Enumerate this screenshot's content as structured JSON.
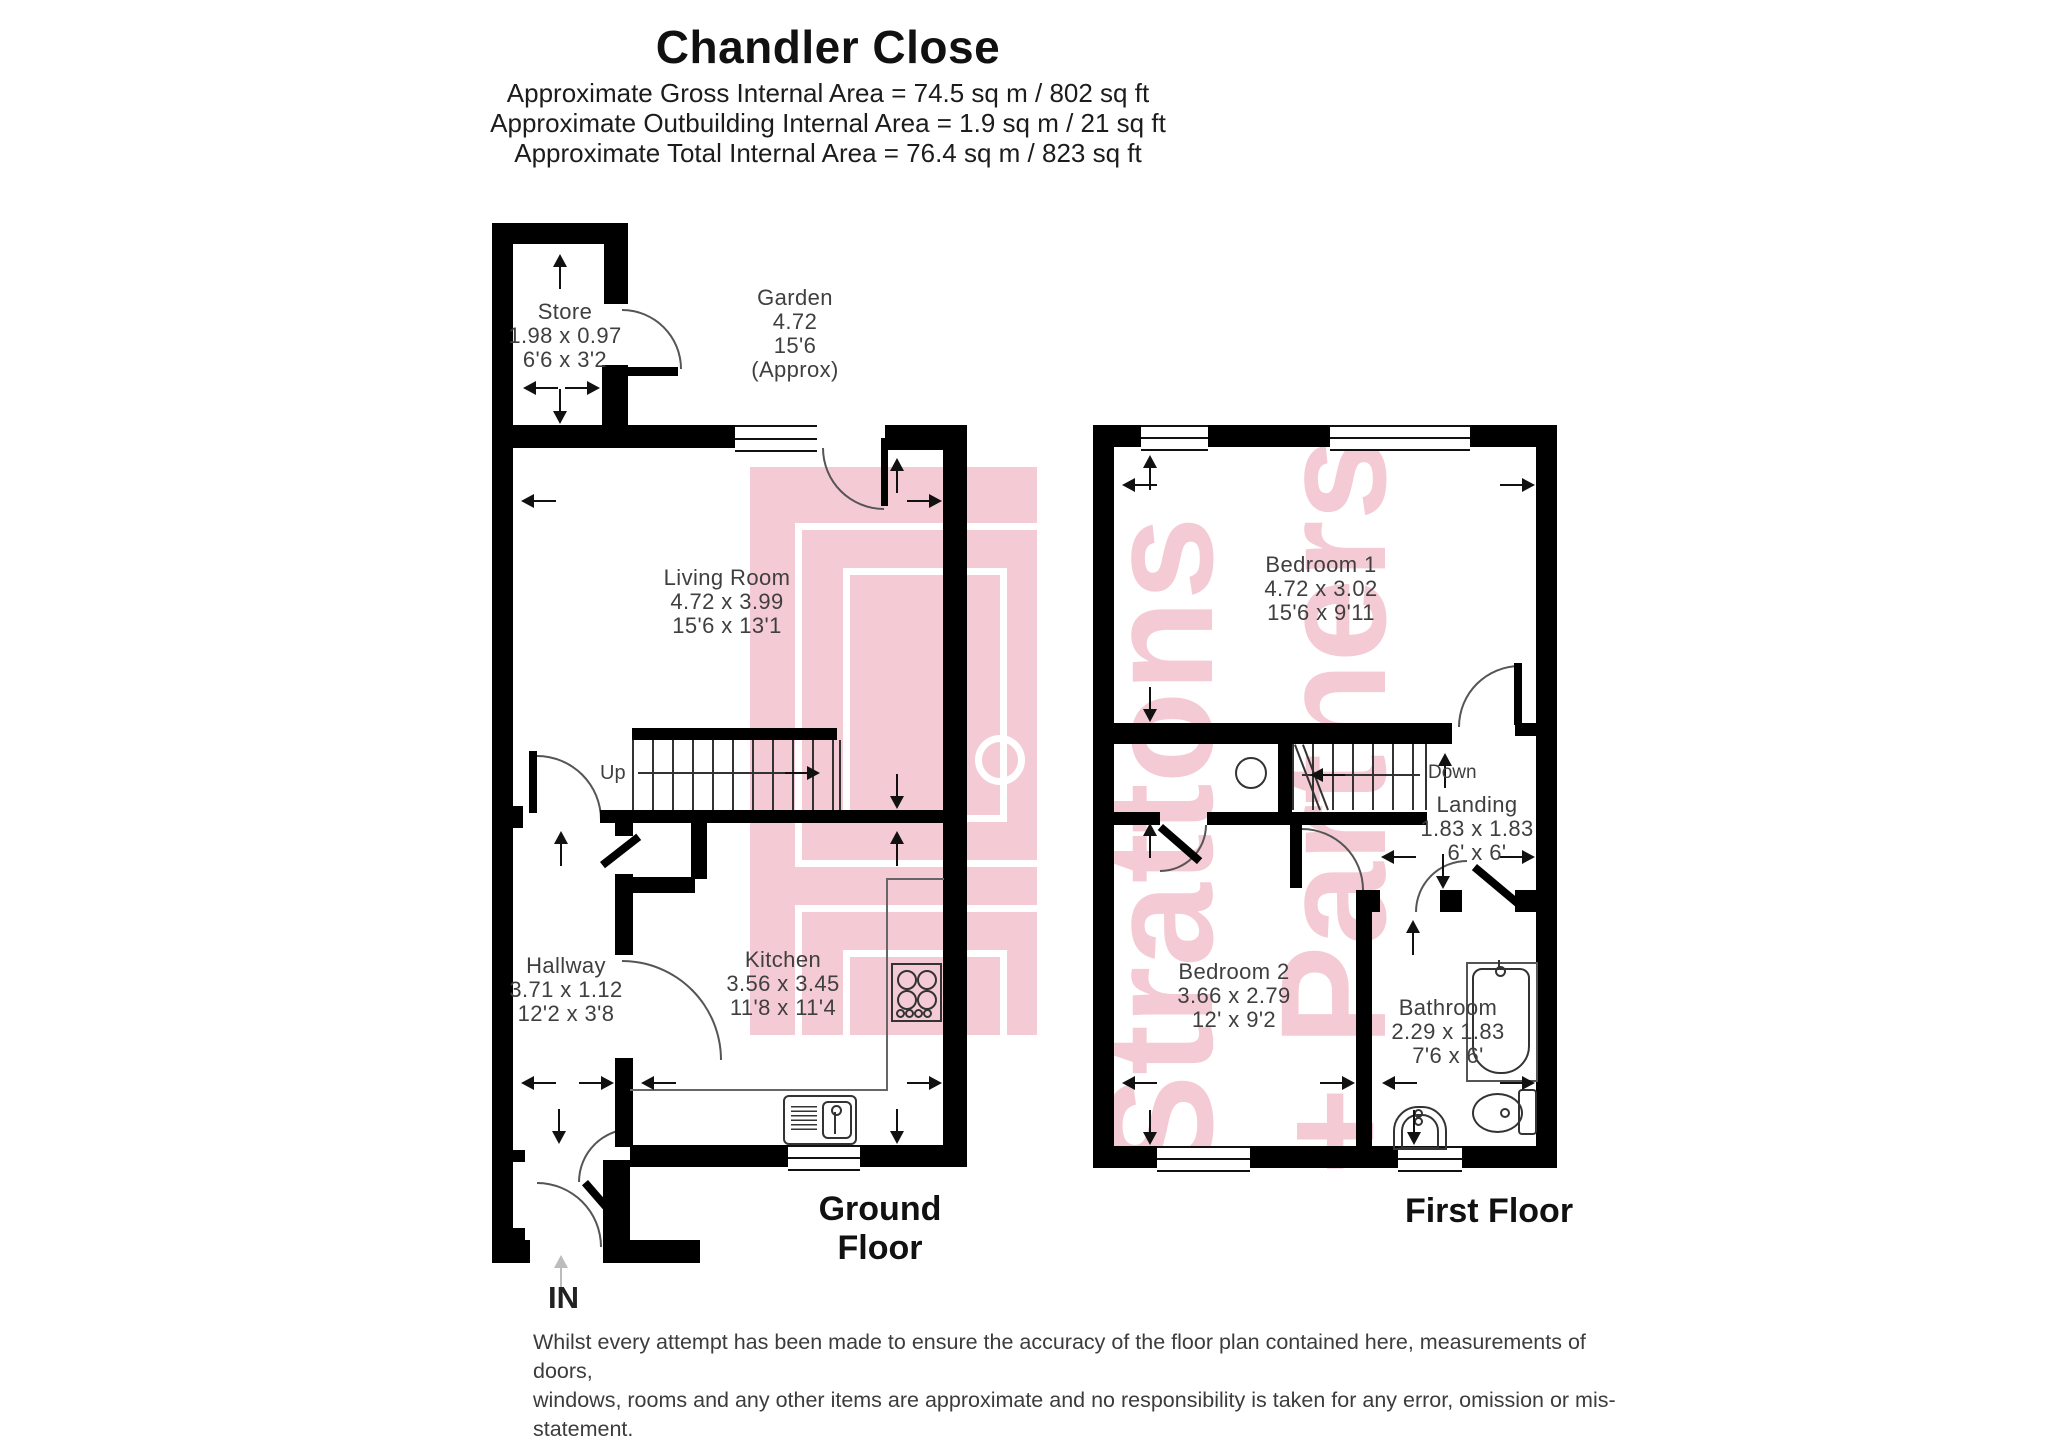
{
  "header": {
    "title": "Chandler Close",
    "area_lines": [
      "Approximate Gross Internal Area = 74.5 sq m / 802 sq ft",
      "Approximate Outbuilding Internal Area = 1.9 sq m / 21 sq ft",
      "Approximate Total Internal Area = 76.4 sq m / 823 sq ft"
    ]
  },
  "rooms": {
    "store": {
      "name": "Store",
      "metric": "1.98 x 0.97",
      "imperial": "6'6 x 3'2"
    },
    "garden": {
      "name": "Garden",
      "metric": "4.72",
      "imperial": "15'6",
      "note": "(Approx)"
    },
    "living_room": {
      "name": "Living Room",
      "metric": "4.72 x 3.99",
      "imperial": "15'6 x 13'1"
    },
    "hallway": {
      "name": "Hallway",
      "metric": "3.71 x 1.12",
      "imperial": "12'2 x 3'8"
    },
    "kitchen": {
      "name": "Kitchen",
      "metric": "3.56 x 3.45",
      "imperial": "11'8 x 11'4"
    },
    "bedroom1": {
      "name": "Bedroom 1",
      "metric": "4.72 x 3.02",
      "imperial": "15'6 x 9'11"
    },
    "landing": {
      "name": "Landing",
      "metric": "1.83 x 1.83",
      "imperial": "6' x 6'"
    },
    "bedroom2": {
      "name": "Bedroom 2",
      "metric": "3.66 x 2.79",
      "imperial": "12' x 9'2"
    },
    "bathroom": {
      "name": "Bathroom",
      "metric": "2.29 x 1.83",
      "imperial": "7'6 x 6'"
    }
  },
  "stairs": {
    "up_label": "Up",
    "down_label": "Down"
  },
  "captions": {
    "ground": "Ground Floor",
    "first": "First Floor",
    "entrance": "IN"
  },
  "disclaimer": {
    "lines": [
      "Whilst every attempt has been made to ensure the accuracy of the floor plan contained here, measurements of doors,",
      "windows, rooms and any other items are approximate and no responsibility is taken for any error, omission or mis-statement.",
      "This plan is for illustrative proposes only and should be used as such by any prospective purchaser.",
      "Produced by Strattons and Partners"
    ]
  },
  "watermark": {
    "line1": "Strattons",
    "line2": "+ Partners",
    "color": "#f4cbd4"
  },
  "colors": {
    "wall": "#000000",
    "arrow": "#111111",
    "label_text": "#3f3f3f",
    "pink": "#f4cbd4"
  }
}
